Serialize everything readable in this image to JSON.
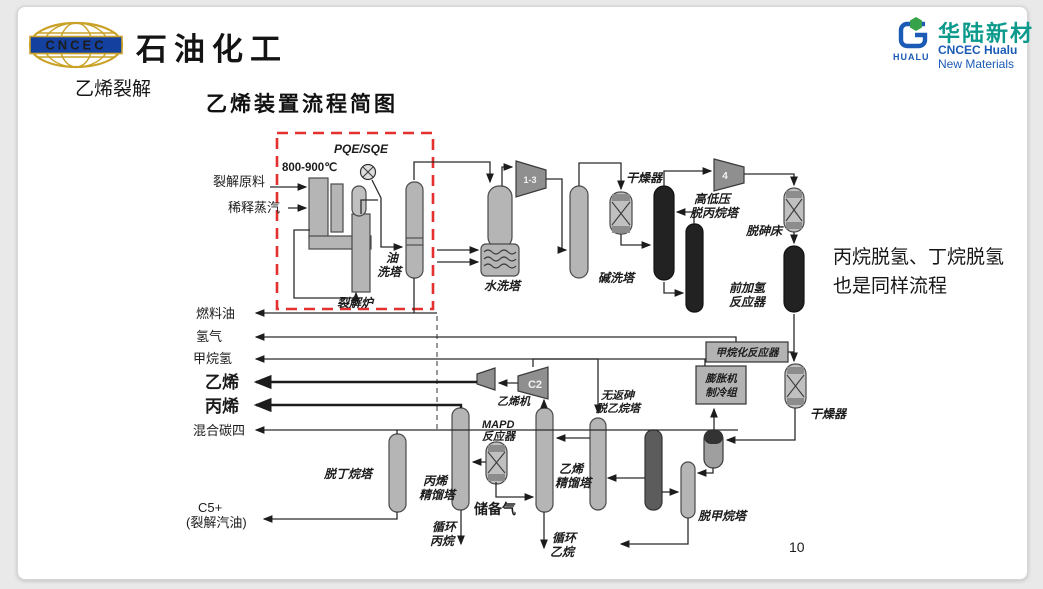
{
  "header": {
    "brand_left": {
      "logo_text": "CNCEC",
      "title": "石油化工"
    },
    "brand_right": {
      "logo_text": "HUALU",
      "name_cn": "华陆新材",
      "name_en_1": "CNCEC Hualu",
      "name_en_2": "New Materials"
    }
  },
  "slide": {
    "section_label": "乙烯裂解",
    "diagram_title": "乙烯装置流程简图",
    "note_line1": "丙烷脱氢、丁烷脱氢",
    "note_line2": "也是同样流程",
    "page_number": "10"
  },
  "d": {
    "temp": "800-900℃",
    "pqe": "PQE/SQE",
    "feed": "裂解原料",
    "steam": "稀释蒸汽",
    "furnace": "裂解炉",
    "oil1": "油",
    "oil2": "洗塔",
    "water": "水洗塔",
    "c13": "1-3",
    "caustic": "碱洗塔",
    "dryer1": "干燥器",
    "c4comp": "4",
    "deprop1": "高低压",
    "deprop2": "脱丙烷塔",
    "arsenic": "脱砷床",
    "hydro1": "前加氢",
    "hydro2": "反应器",
    "methanation": "甲烷化反应器",
    "expander1": "膨胀机",
    "expander2": "制冷组",
    "dryer2": "干燥器",
    "fuel_oil": "燃料油",
    "hydrogen": "氢气",
    "methane_h2": "甲烷氢",
    "ethylene": "乙烯",
    "propylene": "丙烯",
    "mixed_c4": "混合碳四",
    "c5_1": "C5+",
    "c5_2": "(裂解汽油)",
    "eth_comp": "乙烯机",
    "c2comp": "C2",
    "mapd1": "MAPD",
    "mapd2": "反应器",
    "reserve_gas": "储备气",
    "debutanizer": "脱丁烷塔",
    "c3split1": "丙烯",
    "c3split2": "精馏塔",
    "rec_prop1": "循环",
    "rec_prop2": "丙烷",
    "c2split1": "乙烯",
    "c2split2": "精馏塔",
    "rec_eth1": "循环",
    "rec_eth2": "乙烷",
    "deeth1": "无返砷",
    "deeth2": "脱乙烷塔",
    "demethanizer": "脱甲烷塔"
  },
  "colors": {
    "highlight_red": "#e53030",
    "temp_red": "#e32b2b",
    "reserve_blue": "#2456c7",
    "hualu_teal": "#0b9a8c",
    "brand_blue": "#1b5bb5",
    "cncec_gold": "#c9a227",
    "cncec_navy": "#14409f"
  }
}
